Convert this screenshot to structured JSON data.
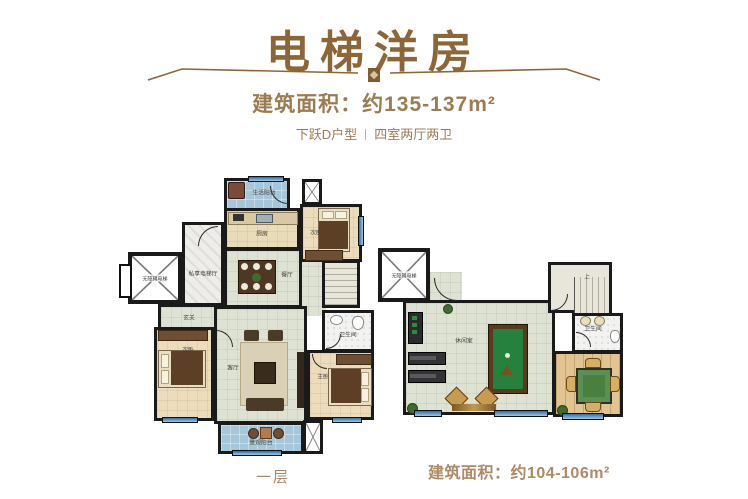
{
  "header": {
    "title": "电梯洋房",
    "area": "建筑面积：约135-137m²",
    "unit_type": "下跃D户型",
    "rooms_spec": "四室两厅两卫"
  },
  "plan_left": {
    "caption": "一层",
    "labels": {
      "service_balcony": "生活阳台",
      "kitchen": "厨房",
      "bedroom_top": "次卧",
      "elevator": "无障碍电梯",
      "elevator_hall": "私享电梯厅",
      "dining": "餐厅",
      "foyer": "玄关",
      "bedroom_left": "次卧",
      "living": "客厅",
      "bathroom": "卫生间",
      "master_bedroom": "主卧",
      "view_balcony": "景观阳台"
    }
  },
  "plan_right": {
    "caption": "建筑面积：约104-106m²",
    "labels": {
      "elevator": "无障碍电梯",
      "leisure": "休闲室",
      "stairs_up": "上",
      "bathroom": "卫生间"
    }
  },
  "colors": {
    "accent_brown": "#8c6637",
    "text_brown": "#9d7b51",
    "caption_brown": "#ad8a64",
    "wall": "#1a1a1a",
    "floor_green": "#dee2d3",
    "balcony_blue": "#a6c7da",
    "bedroom_tan": "#ecdcbc",
    "marble": "#efede9",
    "wood": "#e2c493",
    "billiard_green": "#26813f"
  }
}
